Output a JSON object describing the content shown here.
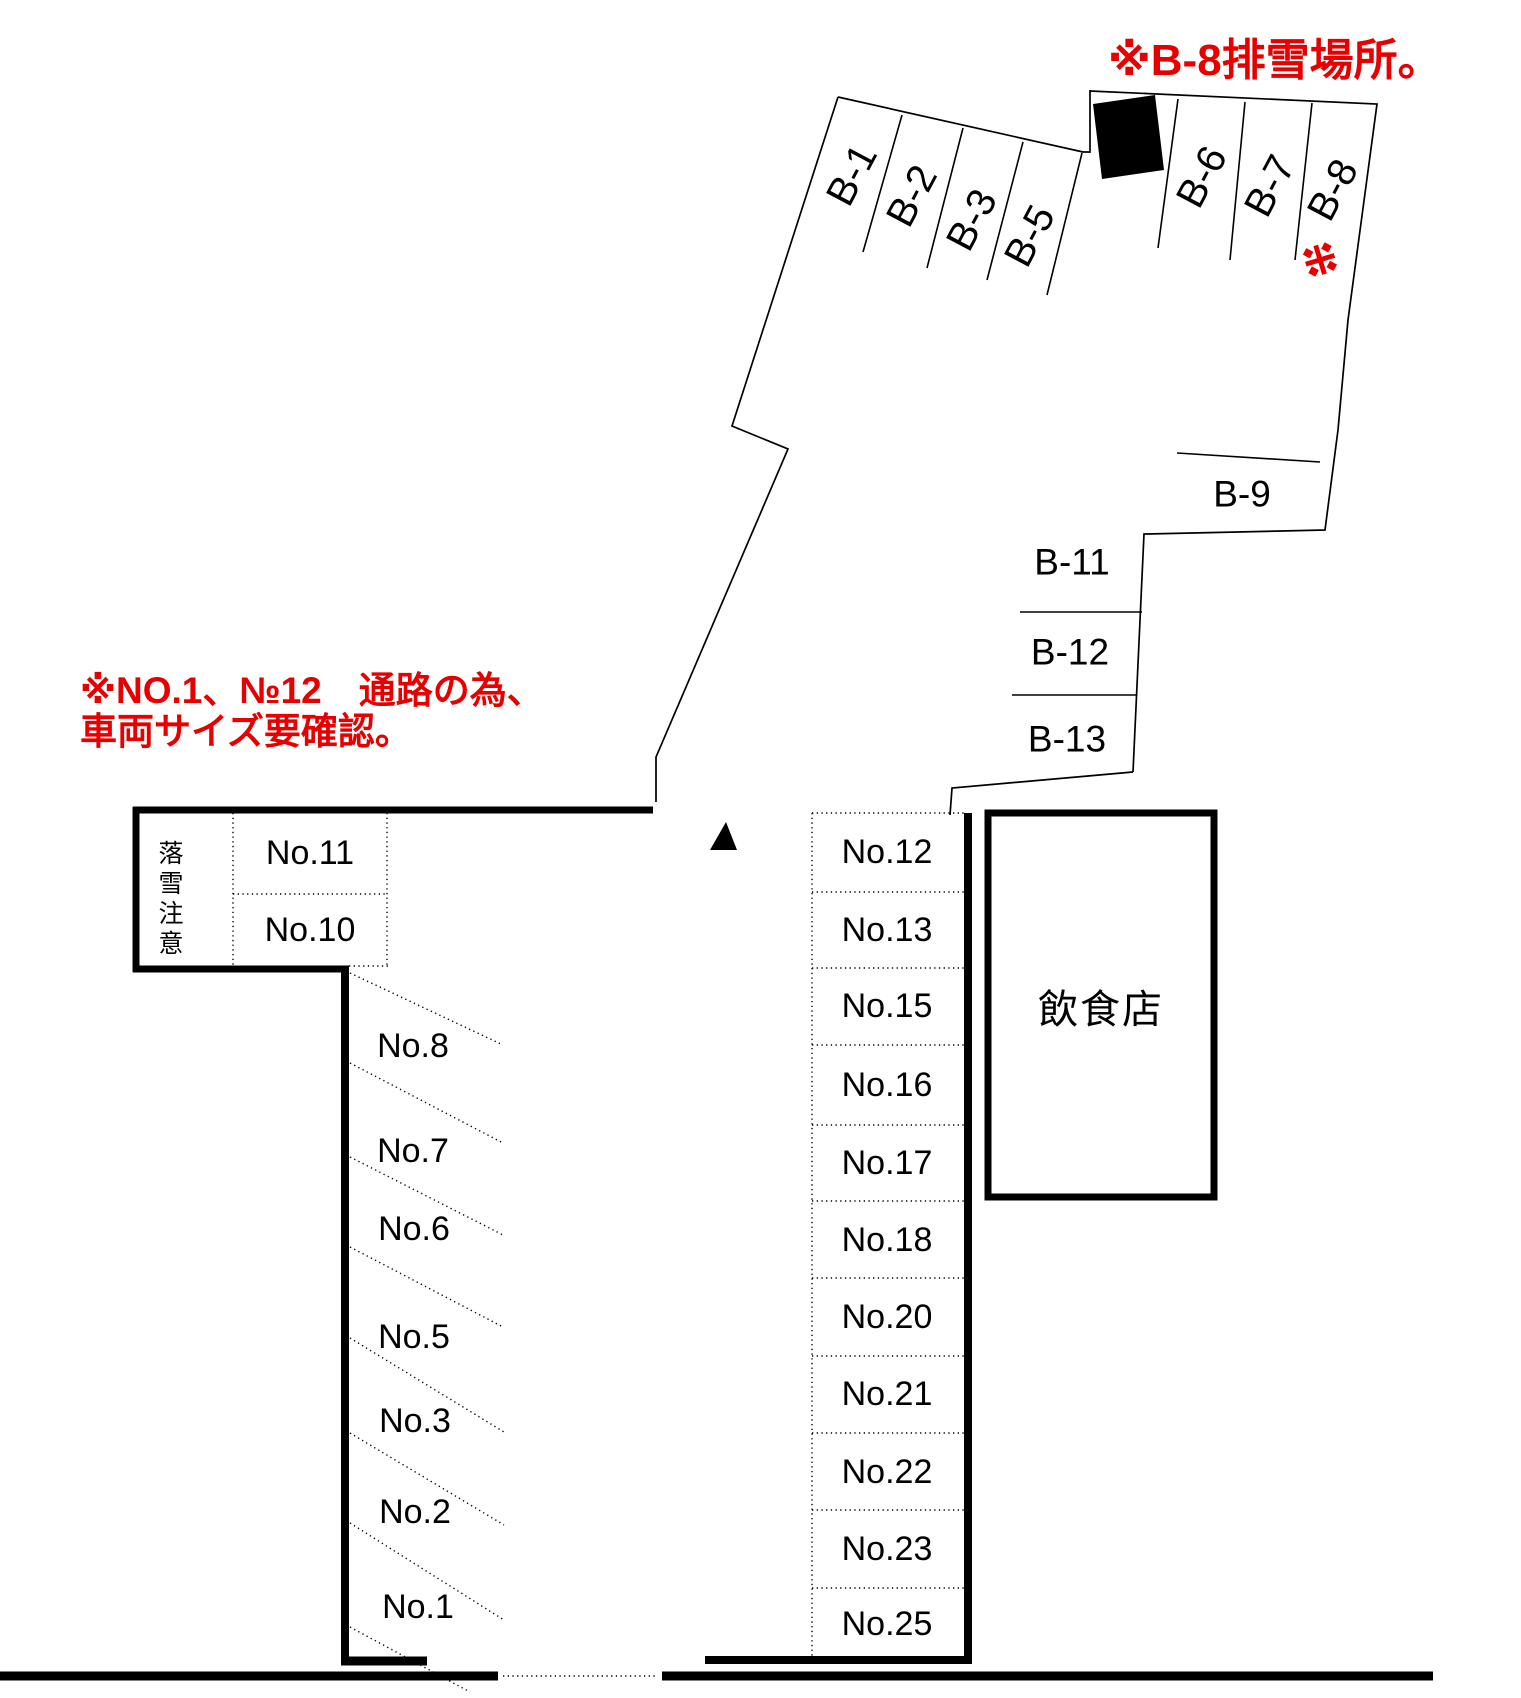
{
  "colors": {
    "accent_red": "#e60000",
    "line_black": "#000000"
  },
  "notes": {
    "header": "※B-8排雪場所。",
    "aisle_line1": "※NO.1、№12　通路の為、",
    "aisle_line2": "車両サイズ要確認。",
    "falling_snow_warning": "落雪注意",
    "b8_marker": "※"
  },
  "angled_spaces": {
    "items": [
      "B-1",
      "B-2",
      "B-3",
      "B-5",
      "B-6",
      "B-7",
      "B-8"
    ]
  },
  "row_spaces": {
    "items": [
      "B-9",
      "B-11",
      "B-12",
      "B-13"
    ]
  },
  "left_section": {
    "upper_cells": [
      "No.11",
      "No.10"
    ],
    "diagonal_cells": [
      "No.8",
      "No.7",
      "No.6",
      "No.5",
      "No.3",
      "No.2",
      "No.1"
    ]
  },
  "middle_column": {
    "cells": [
      "No.12",
      "No.13",
      "No.15",
      "No.16",
      "No.17",
      "No.18",
      "No.20",
      "No.21",
      "No.22",
      "No.23",
      "No.25"
    ]
  },
  "restaurant": {
    "label": "飲食店"
  }
}
